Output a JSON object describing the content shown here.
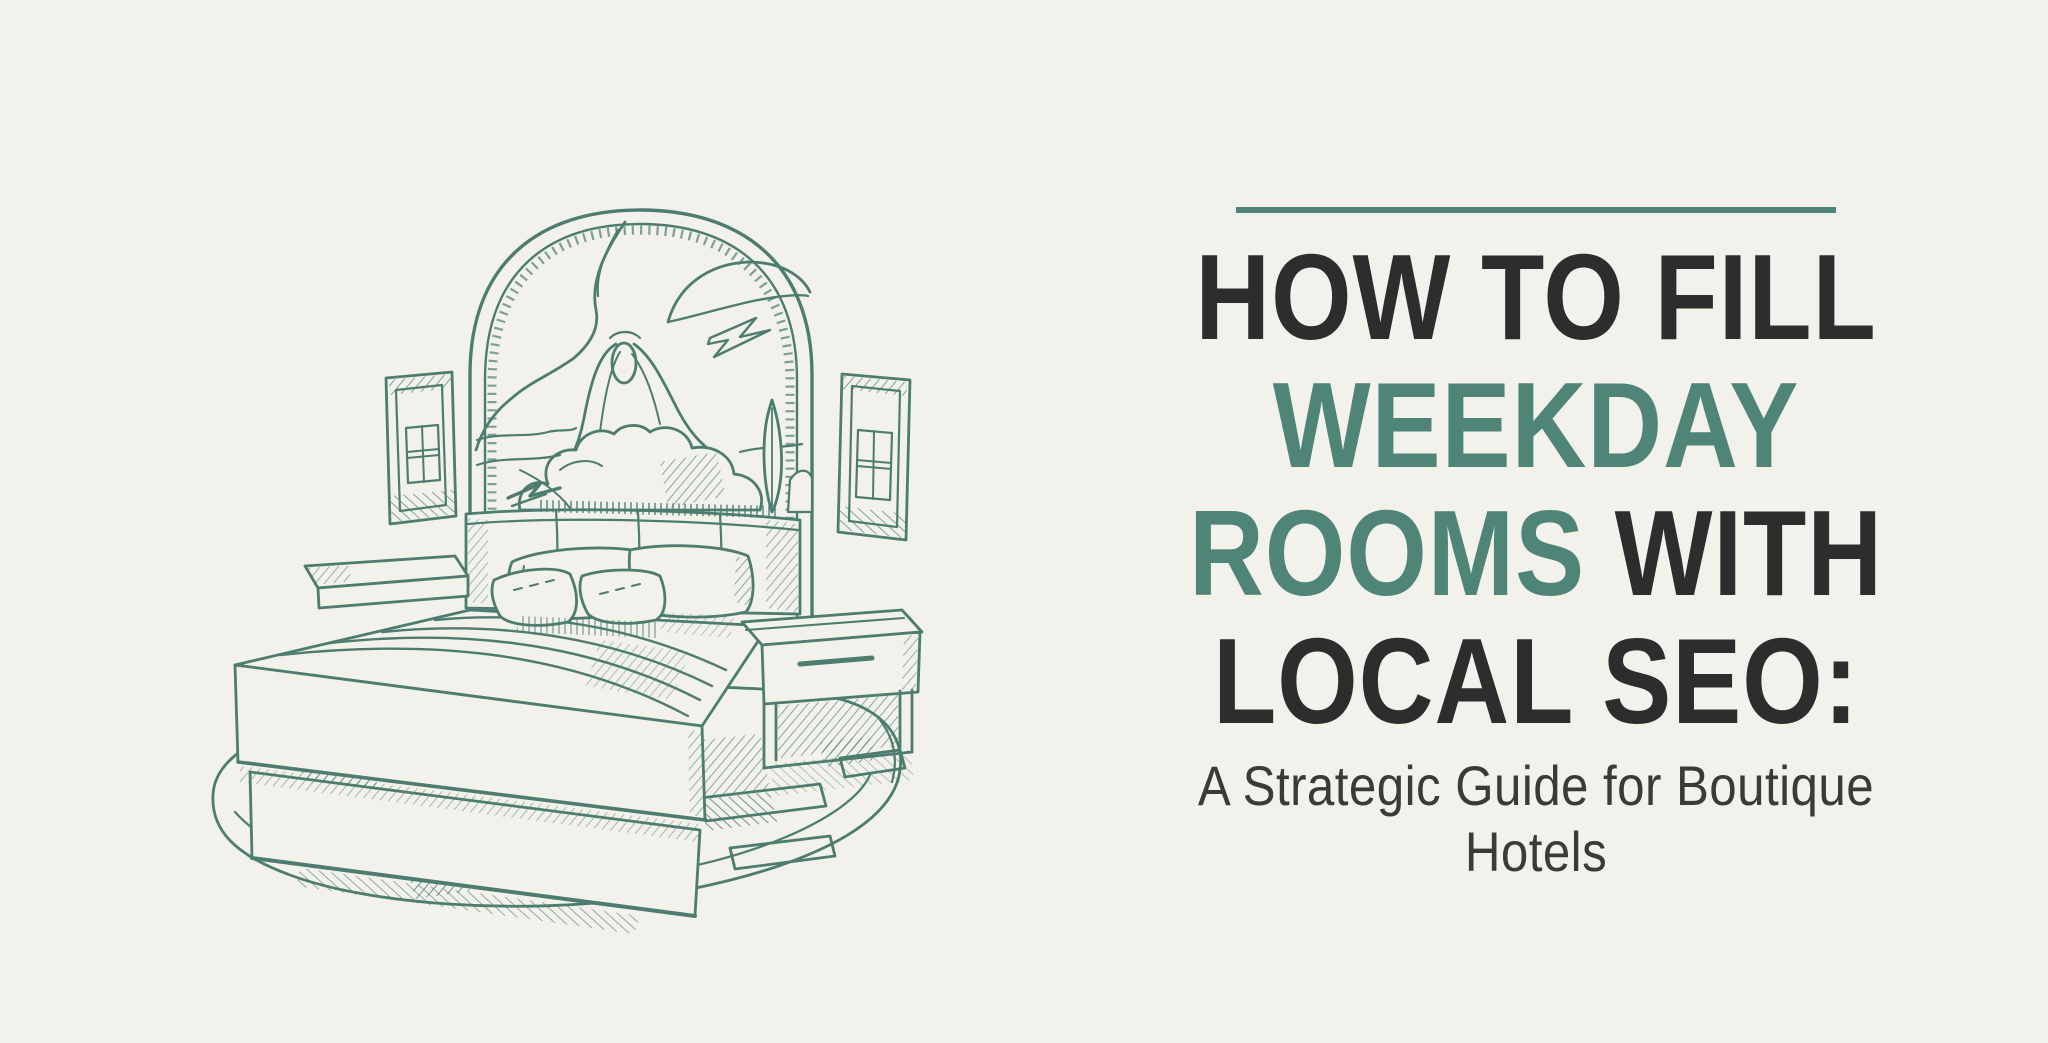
{
  "page": {
    "background_color": "#f2f1ec"
  },
  "colors": {
    "accent_teal": "#4e8577",
    "title_dark": "#2d2d2d",
    "subtitle_gray": "#3a3a3a",
    "sketch_stroke": "#4c7d6f"
  },
  "title": {
    "line1": "HOW TO FILL",
    "line2": "WEEKDAY",
    "line3_accent": "ROOMS",
    "line3_rest": " WITH",
    "line4": "LOCAL SEO:"
  },
  "subtitle": {
    "line1": "A Strategic Guide for Boutique",
    "line2": "Hotels"
  },
  "illustration": {
    "name": "hand-drawn-hotel-bed-sketch"
  }
}
